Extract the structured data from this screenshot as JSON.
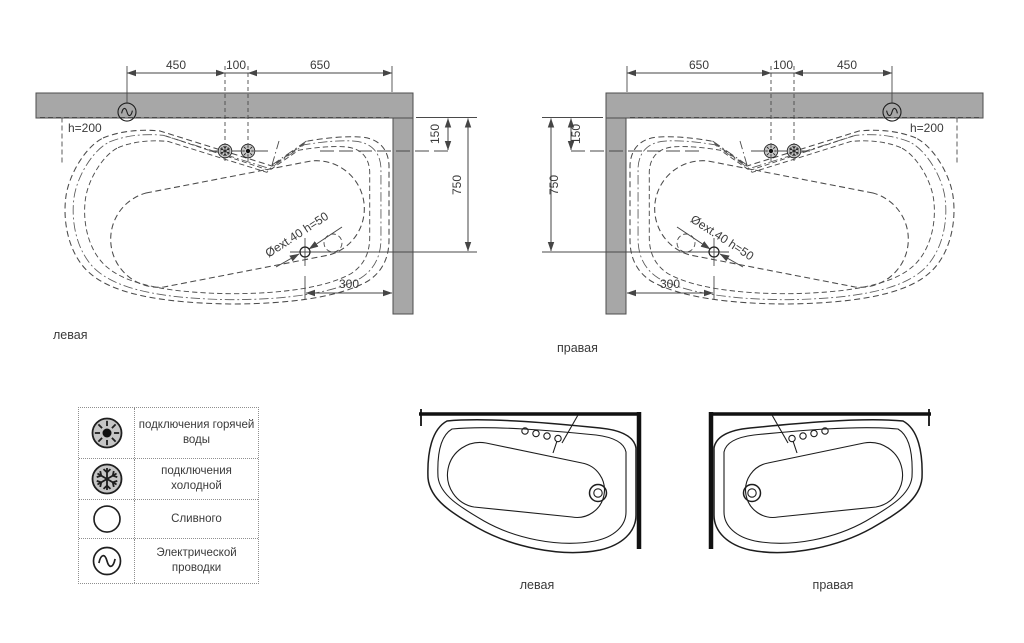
{
  "colors": {
    "wall_fill": "#a7a7a7",
    "wall_stroke": "#4d4d4d",
    "drawing_line": "#4a4a4a",
    "text": "#3a3a3a",
    "tub_line": "#1d1d1d",
    "symbol_fill": "#c6c6c6"
  },
  "plan_left": {
    "label": "левая",
    "wall_height_label": "h=200",
    "drain_label": "Øext.40 h=50",
    "dims": {
      "top": [
        "450",
        "100",
        "650"
      ],
      "side": [
        "150",
        "750"
      ],
      "bottom": "300"
    }
  },
  "plan_right": {
    "label": "правая",
    "wall_height_label": "h=200",
    "drain_label": "Øext.40 h=50",
    "dims": {
      "top": [
        "650",
        "100",
        "450"
      ],
      "side": [
        "150",
        "750"
      ],
      "bottom": "300"
    }
  },
  "elevation_left": {
    "label": "левая"
  },
  "elevation_right": {
    "label": "правая"
  },
  "legend": {
    "rows": [
      {
        "icon": "hot-water-icon",
        "label": "подключения горячей воды"
      },
      {
        "icon": "cold-water-icon",
        "label": "подключения холодной"
      },
      {
        "icon": "drain-icon",
        "label": "Сливного"
      },
      {
        "icon": "electrical-icon",
        "label": "Электрической проводки"
      }
    ]
  }
}
